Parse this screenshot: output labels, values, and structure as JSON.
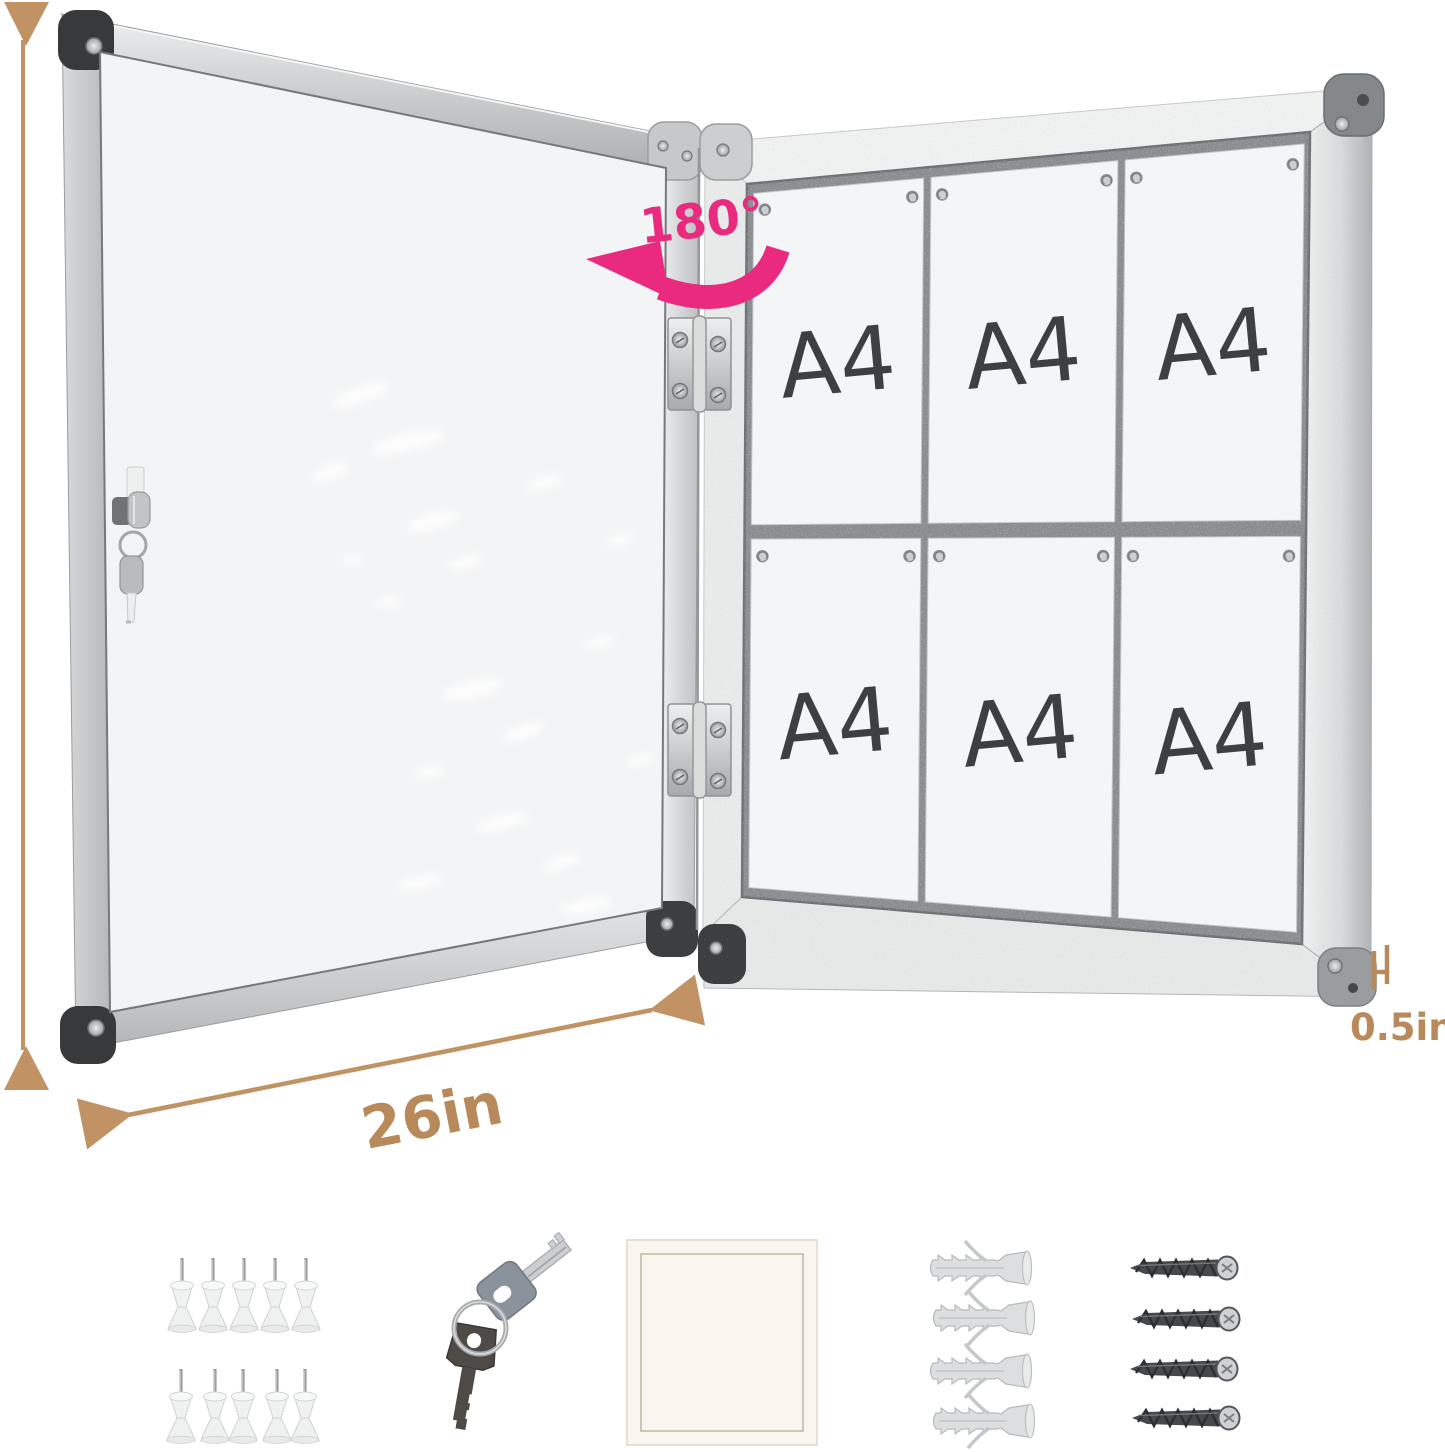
{
  "product_view": {
    "rotation_label": "180°",
    "height_label": "28in",
    "width_label": "26in",
    "depth_label": "0.5in",
    "paper_labels": [
      "A4",
      "A4",
      "A4",
      "A4",
      "A4",
      "A4"
    ]
  },
  "accessories": {
    "pushpins_count": 10,
    "keys_count": 2,
    "anchors_count": 4,
    "screws_count": 4
  },
  "colors": {
    "dimension_text": "#b8895a",
    "rotation_accent": "#ea2a7f",
    "paper_label": "#3d3f41",
    "frame_silver": "#c8cacc",
    "felt_gray": "#898d8f"
  }
}
